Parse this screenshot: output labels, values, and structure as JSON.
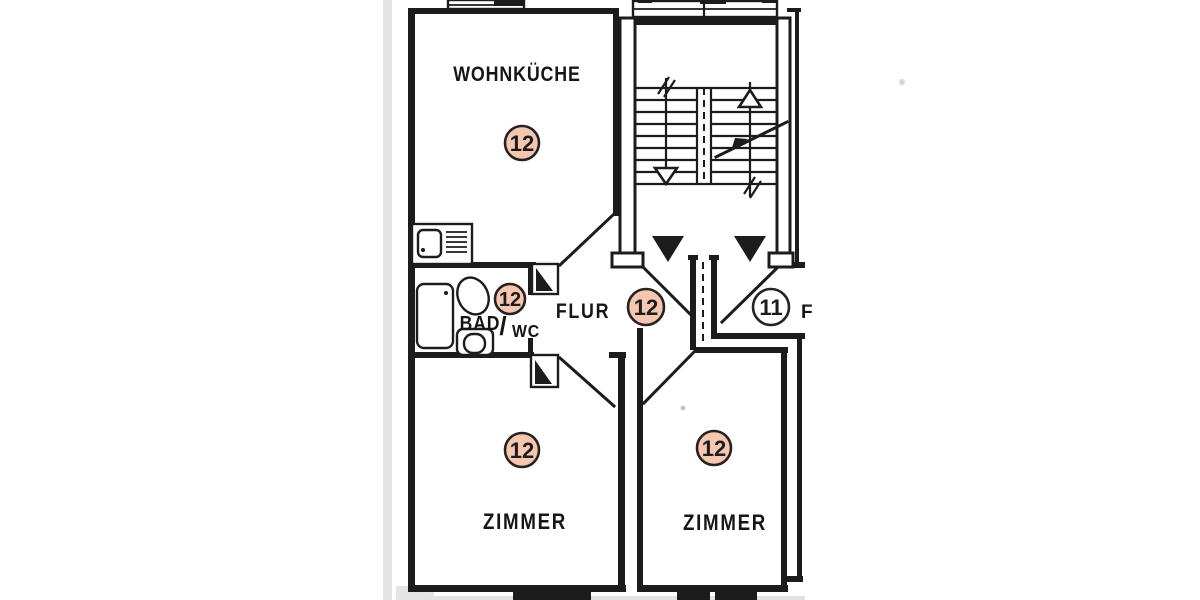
{
  "plan": {
    "paper_color": "#ffffff",
    "ink_color": "#1c1c1c",
    "highlight_color": "#f6c7b0",
    "rooms": {
      "wohnkueche": {
        "label": "WOHNKÜCHE",
        "badge": "12"
      },
      "bad_wc": {
        "label_bad": "BAD",
        "label_slash": "/",
        "label_wc": "WC",
        "badge": "12"
      },
      "flur": {
        "label": "FLUR",
        "badge": "12"
      },
      "zimmer_left": {
        "label": "ZIMMER",
        "badge": "12"
      },
      "zimmer_right": {
        "label": "ZIMMER",
        "badge": "12"
      },
      "neighbor_unit": {
        "label_partial": "F",
        "badge": "11"
      }
    }
  }
}
